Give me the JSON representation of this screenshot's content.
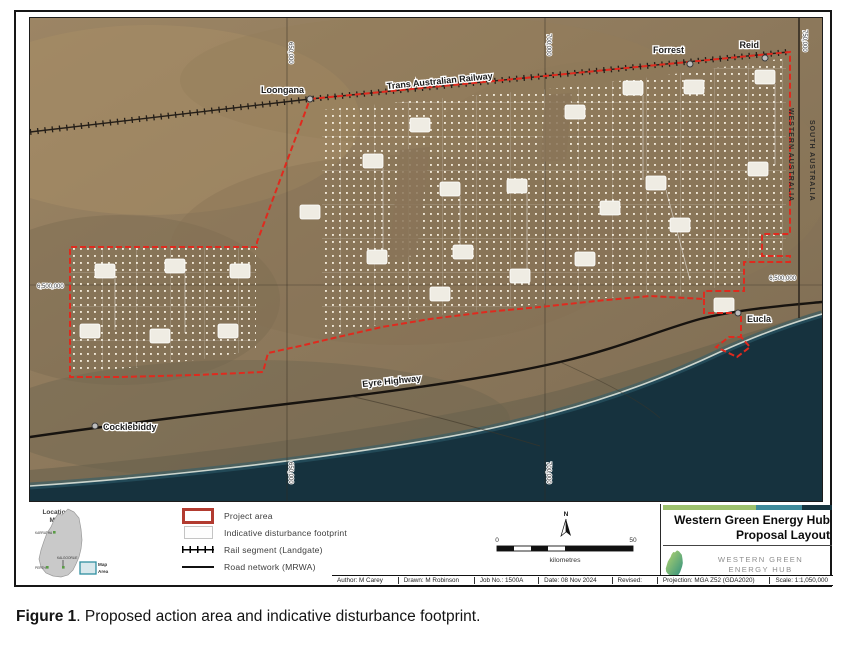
{
  "figure": {
    "caption_bold": "Figure 1",
    "caption_rest": ". Proposed action area and indicative disturbance footprint."
  },
  "map": {
    "towns": {
      "loongana": "Loongana",
      "forrest": "Forrest",
      "reid": "Reid",
      "eucla": "Eucla",
      "cocklebiddy": "Cocklebiddy"
    },
    "labels": {
      "railway": "Trans Australian Railway",
      "highway": "Eyre Highway",
      "state_left": "WESTERN AUSTRALIA",
      "state_right": "SOUTH AUSTRALIA"
    },
    "grid_labels": {
      "northing_left": "6,500,000",
      "northing_right": "6,500,000",
      "easting_1": "650,000",
      "easting_2": "700,000",
      "easting_3": "750,000"
    },
    "colors": {
      "project_boundary": "#df2a1e",
      "land": "#8a7458",
      "ocean": "#16323e",
      "footprint_dot": "#f5eedd"
    }
  },
  "inset": {
    "title_line1": "Location",
    "title_line2": "Map",
    "towns": [
      "KARRATHA",
      "KALGOORLIE",
      "PERTH"
    ],
    "map_area_line1": "Map",
    "map_area_line2": "Area"
  },
  "legend": {
    "items": [
      {
        "label": "Project area"
      },
      {
        "label": "Indicative disturbance footprint"
      },
      {
        "label": "Rail segment (Landgate)"
      },
      {
        "label": "Road network (MRWA)"
      }
    ]
  },
  "scalebar": {
    "start": "0",
    "end": "50",
    "unit": "kilometres",
    "north": "N"
  },
  "titleblock": {
    "title_line1": "Western Green Energy Hub",
    "title_line2": "Proposal Layout",
    "logo_line1": "WESTERN GREEN",
    "logo_line2": "ENERGY HUB"
  },
  "credits": {
    "author": "Author: M Carey",
    "drawn": "Drawn: M Robinson",
    "job": "Job No.: 1500A",
    "date": "Date: 08 Nov 2024",
    "revised": "Revised:",
    "projection": "Projection: MGA Z52 (GDA2020)",
    "scale": "Scale: 1:1,050,000"
  }
}
